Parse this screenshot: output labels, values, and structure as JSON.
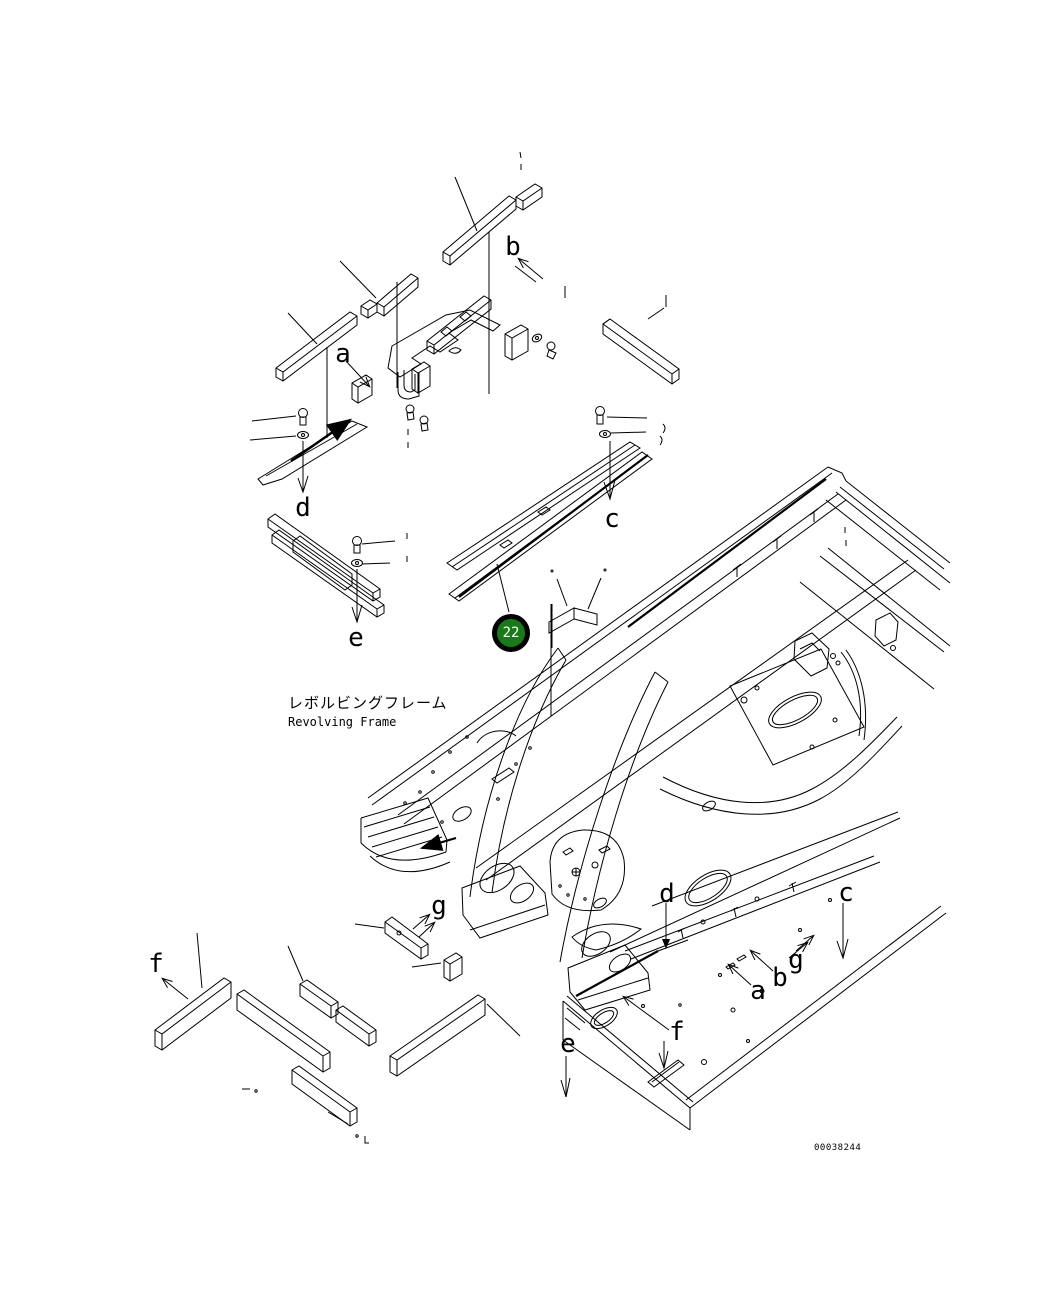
{
  "figure": {
    "title_ja": "レボルビングフレーム",
    "title_en": "Revolving Frame",
    "drawing_number": "00038244"
  },
  "balloon": {
    "number": "22",
    "fill_color": "#1a7a1a",
    "ring_color": "#000000",
    "text_color": "#ffffff"
  },
  "colors": {
    "background": "#ffffff",
    "line": "#000000"
  },
  "callouts": [
    {
      "id": "a-top",
      "label": "a"
    },
    {
      "id": "b-top",
      "label": "b"
    },
    {
      "id": "c-rail",
      "label": "c"
    },
    {
      "id": "d-rail",
      "label": "d"
    },
    {
      "id": "e-rail",
      "label": "e"
    },
    {
      "id": "f-bars",
      "label": "f"
    },
    {
      "id": "g-bars",
      "label": "g"
    },
    {
      "id": "d-frame",
      "label": "d"
    },
    {
      "id": "c-frame",
      "label": "c"
    },
    {
      "id": "g-frame",
      "label": "g"
    },
    {
      "id": "b-frame",
      "label": "b"
    },
    {
      "id": "a-frame",
      "label": "a"
    },
    {
      "id": "f-frame",
      "label": "f"
    },
    {
      "id": "e-frame",
      "label": "e"
    }
  ]
}
